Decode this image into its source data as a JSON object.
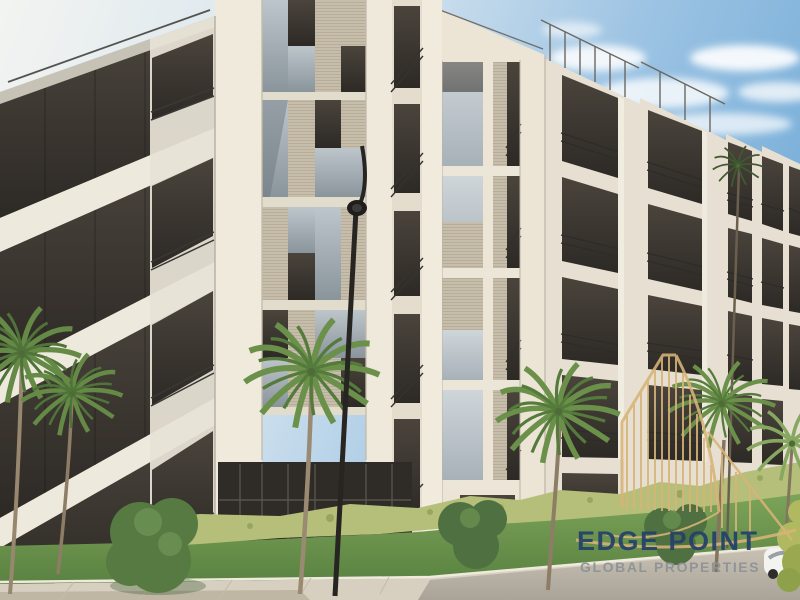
{
  "image": {
    "kind": "architectural rendering",
    "subject": "modern low-rise apartment building exterior with palm trees, hedges, lawn, sidewalk and street lamp under a blue sky"
  },
  "watermark": {
    "line1": "EDGE POINT",
    "line2": "GLOBAL PROPERTIES",
    "logo_icon": "highrise-building-outline-icon",
    "colors": {
      "logo_gold": "#D8B478",
      "brand_navy": "#24416B",
      "subtitle_gray": "#8D9298"
    }
  },
  "scene": {
    "elements": [
      "apartment-building",
      "balconies-with-railings",
      "panel-mosaic-facade",
      "rooftop-railing",
      "palm-trees",
      "tall-slender-palm",
      "hedge-row",
      "bushes",
      "lawn",
      "paved-sidewalk",
      "road",
      "street-lamp",
      "white-car",
      "clouds",
      "blue-sky"
    ],
    "palette": {
      "facade_cream": "#EFE9DC",
      "facade_shaded": "#DAD3C5",
      "glazing_dark": "#38322C",
      "glass_sky_reflection": "#AFBAC0",
      "panel_mesh_beige": "#C7BDAB",
      "sky_blue": "#83B4DB",
      "grass_green": "#6E9A50",
      "hedge_green": "#B6C07A",
      "bush_green": "#567A42",
      "pavement": "#D8D1C2",
      "lamp_black": "#262522"
    }
  }
}
